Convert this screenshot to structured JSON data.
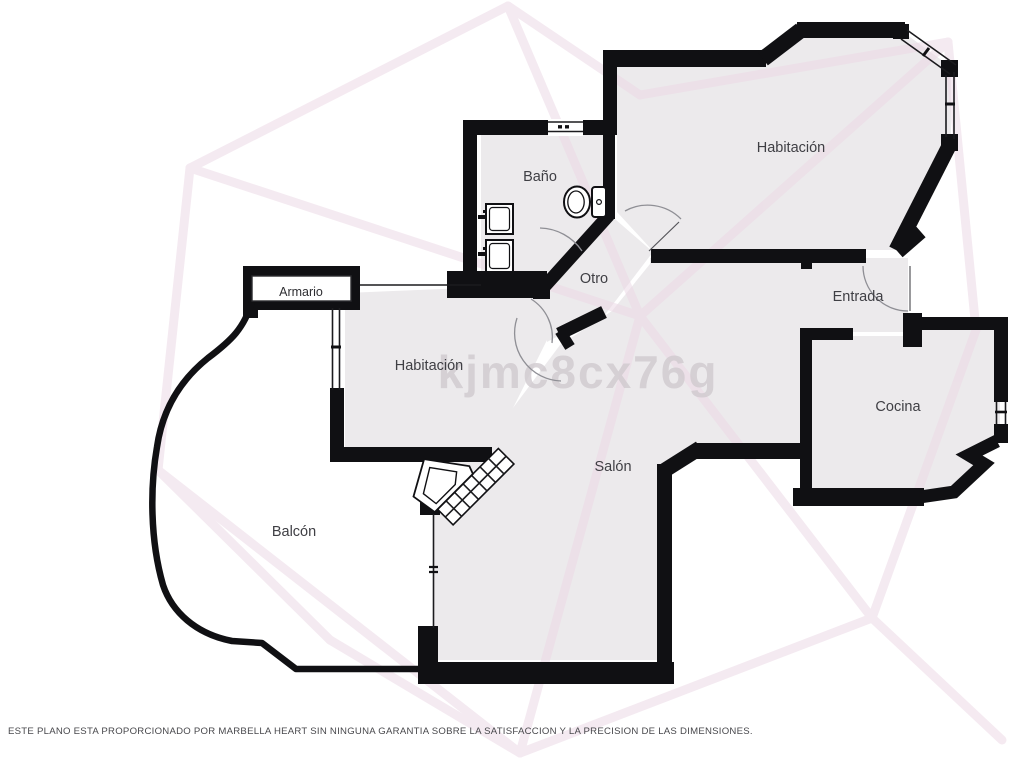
{
  "floorplan": {
    "watermark": "kjmc8cx76g",
    "disclaimer": "ESTE PLANO ESTA PROPORCIONADO POR MARBELLA HEART SIN NINGUNA GARANTIA SOBRE LA SATISFACCION Y LA PRECISION DE LAS DIMENSIONES.",
    "rooms": [
      {
        "name": "bedroom-1",
        "label": "Habitación"
      },
      {
        "name": "bathroom",
        "label": "Baño"
      },
      {
        "name": "hall",
        "label": "Otro"
      },
      {
        "name": "entrance",
        "label": "Entrada"
      },
      {
        "name": "bedroom-2",
        "label": "Habitación"
      },
      {
        "name": "kitchen",
        "label": "Cocina"
      },
      {
        "name": "living-room",
        "label": "Salón"
      },
      {
        "name": "balcony",
        "label": "Balcón"
      },
      {
        "name": "closet",
        "label": "Armario"
      }
    ],
    "fixtures": [
      "toilet-icon",
      "sink-icon",
      "sink-icon",
      "fireplace-icon"
    ],
    "colors": {
      "wall": "#101013",
      "room_fill": "#eceaec",
      "background": "#ffffff",
      "pattern_line": "#ecd9e6",
      "door_arc": "#8f8f95",
      "label_text": "#3f3f44",
      "watermark_text": "#cfc9ce"
    }
  }
}
